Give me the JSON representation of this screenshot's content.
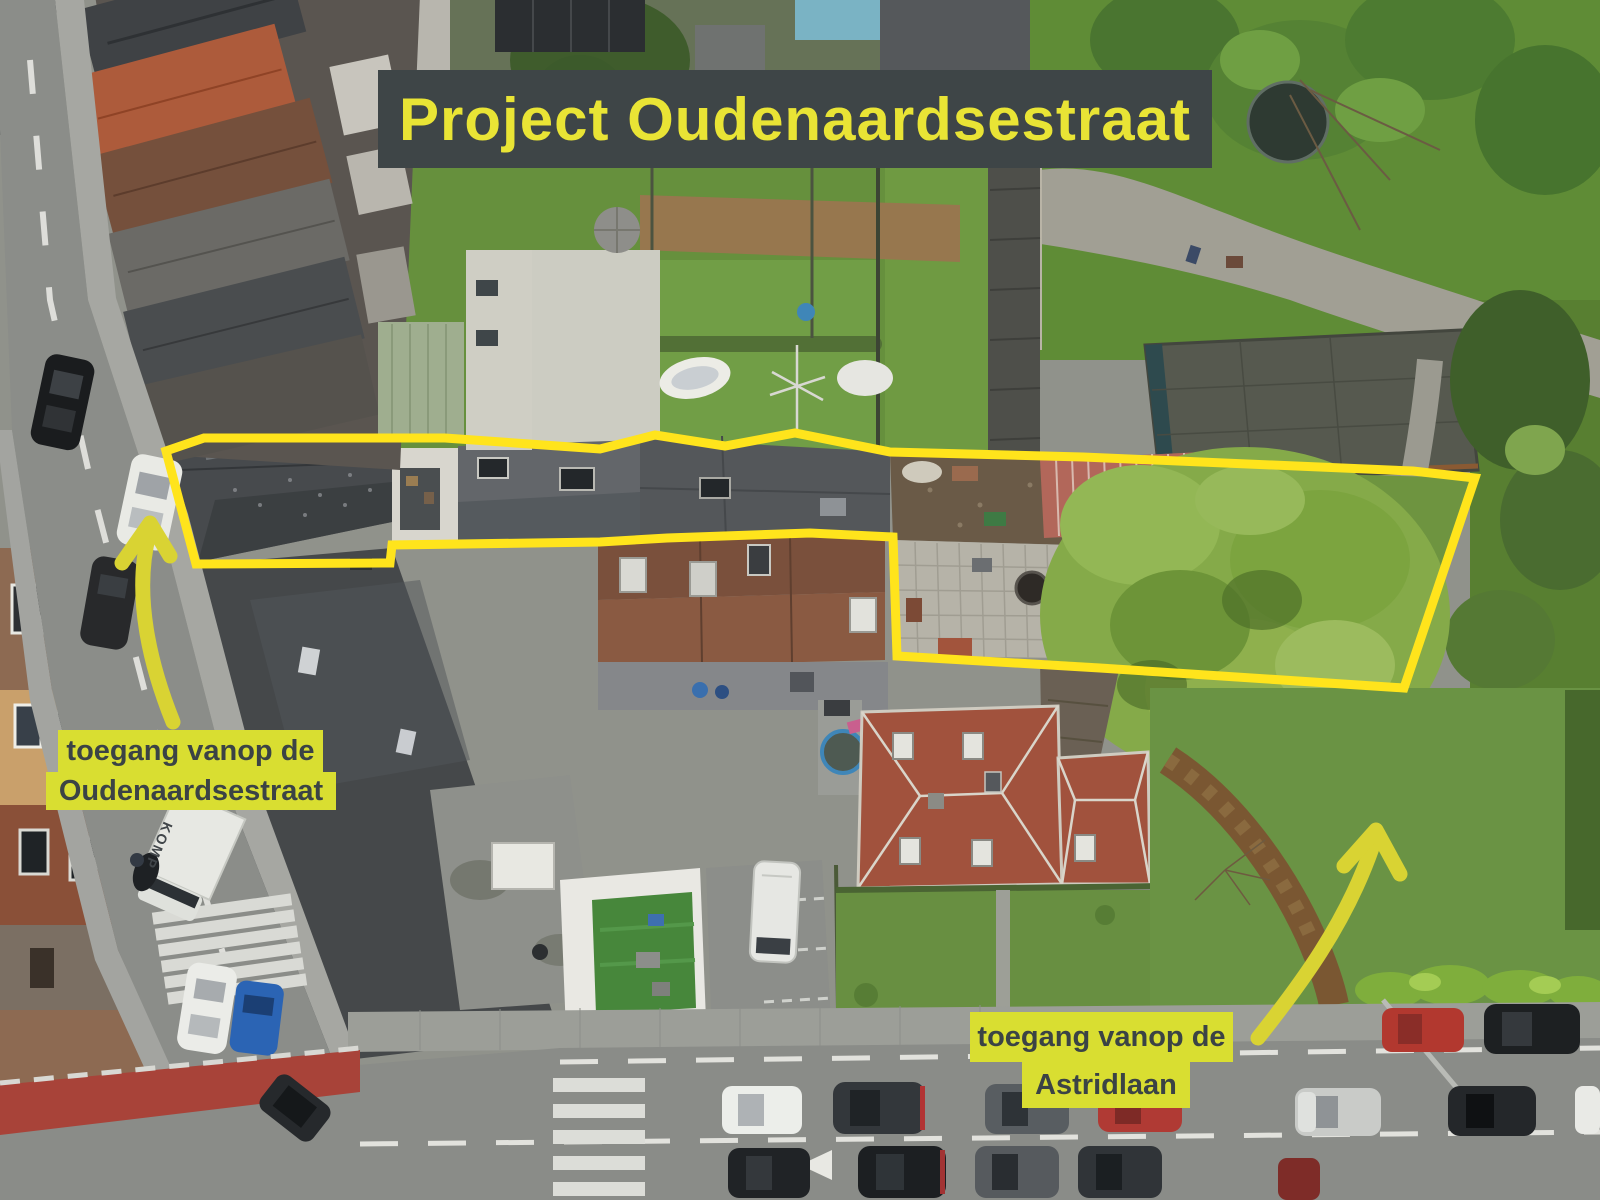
{
  "annotations": {
    "title_banner": {
      "text": "Project Oudenaardsestraat",
      "bg": "#3e4547",
      "fg": "#e9e435"
    },
    "left_label": {
      "line1": "toegang vanop de",
      "line2": "Oudenaardsestraat",
      "bg": "#d9de31",
      "fg": "#3b4345"
    },
    "right_label": {
      "line1": "toegang vanop de",
      "line2": "Astridlaan",
      "bg": "#d9de31",
      "fg": "#3b4345"
    },
    "truck_text": "KOMP"
  },
  "site_outline": {
    "points": "166,451 204,438 445,438 600,449 655,435 725,446 795,433 890,452 1083,457 1413,471 1475,478 1404,688 1100,668 897,656 893,537 810,533 667,538 600,542 392,545 390,563 196,564",
    "stroke": "#ffe41c",
    "stroke_width": 9
  },
  "arrows": {
    "color": "#d9d333",
    "left": {
      "shaft": "M 173 722 C 150 665 133 595 149 534",
      "head": "M 122 563 L 150 523 L 170 556"
    },
    "right": {
      "shaft": "M 1258 1038 C 1300 985 1345 925 1372 848",
      "head": "M 1344 866 L 1376 830 L 1400 874"
    }
  },
  "palette": {
    "road": "#8b8d89",
    "sidewalk": "#a6a7a2",
    "bike_lane_red": "#a84339",
    "lawn_green": "#66903d",
    "tree_green": "#85aa49",
    "slate_roof": "#474a4d",
    "orange_roof": "#ad5b3b",
    "villa_roof": "#a1523d",
    "red_shed": "#b2675a"
  }
}
